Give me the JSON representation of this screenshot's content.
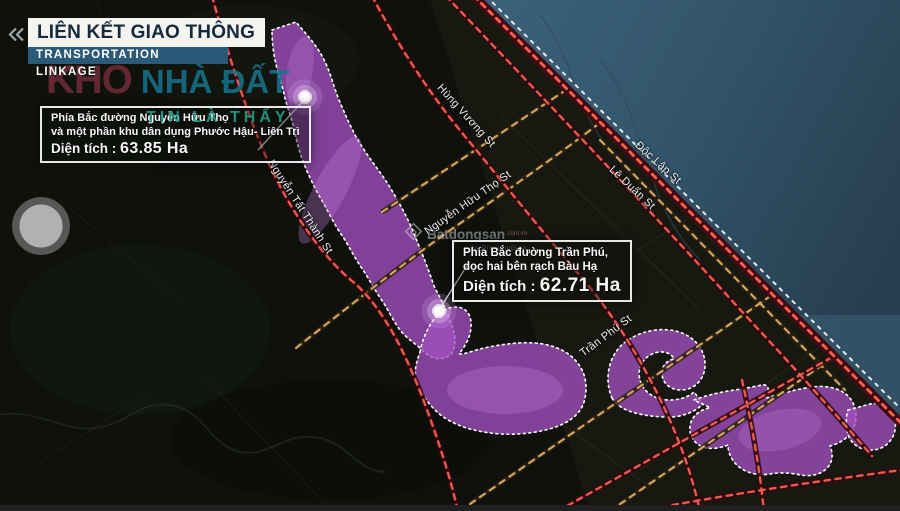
{
  "header": {
    "title": "LIÊN KẾT GIAO THÔNG",
    "subtitle": "TRANSPORTATION LINKAGE"
  },
  "brand": {
    "word1": "KHO",
    "word2": "NHÀ ĐẤT",
    "tagline": "TIN LÀ THẤY"
  },
  "map_watermark": {
    "brand": "Batdongsan",
    "domain": ".com.vn",
    "byline": "by PropertyGuru"
  },
  "boxes": [
    {
      "line1": "Phía Bắc đường Nguyễn Hữu Thọ",
      "line2": "và một phần khu dân dụng Phước Hậu- Liên Trì",
      "area_label": "Diện tích :",
      "area_value": "63.85 Ha"
    },
    {
      "line1": "Phía Bắc đường Trần Phú,",
      "line2": "dọc hai bên rạch Bàu Hạ",
      "area_label": "Diện tích :",
      "area_value": "62.71 Ha"
    }
  ],
  "streets": [
    {
      "name": "Nguyễn Tất Thành St"
    },
    {
      "name": "Hùng Vương St"
    },
    {
      "name": "Nguyễn Hữu Thọ St"
    },
    {
      "name": "Độc Lập St"
    },
    {
      "name": "Lê Duẩn St"
    },
    {
      "name": "Trần Phú St"
    }
  ],
  "colors": {
    "zone_fill": "#a24fc0",
    "zone_border": "#ffffff",
    "road_primary_dash": "#e85a4c",
    "road_secondary_dash": "#d4a558",
    "coast_road_dash": "#ff6052",
    "sea": "#33566c",
    "title_text": "#17293c",
    "subtitle_bar_bg": "#2a5a78",
    "brand_red": "#702a38",
    "brand_teal": "#16748e"
  }
}
